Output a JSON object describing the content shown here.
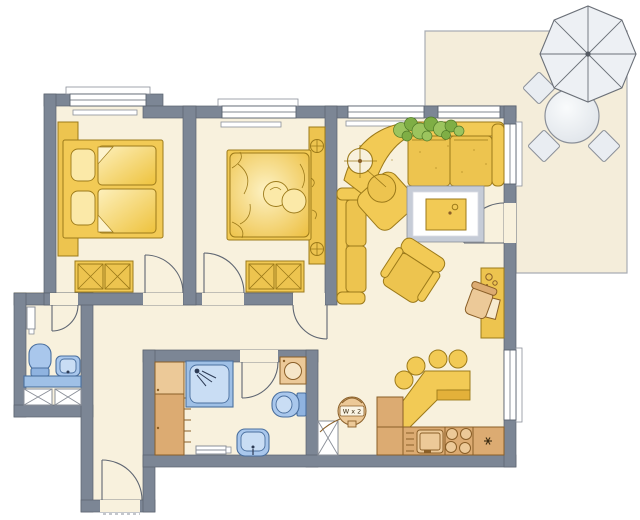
{
  "plan": {
    "type": "apartment-floor-plan",
    "boiler_label": "W x 2",
    "palette": {
      "wall": "#7c8695",
      "wallEdge": "#5a626e",
      "floor": "#f8f1dd",
      "gold": "#f2ca55",
      "goldMid": "#edc44f",
      "goldPale": "#fbe9a8",
      "goldDeep": "#e3b13a",
      "goldDark": "#9c7a1a",
      "tan": "#dcab72",
      "tanLight": "#ecc998",
      "tanDark": "#8a5f28",
      "blue": "#8fb3e0",
      "blueMid": "#a9c7ec",
      "blueLight": "#c9ddf4",
      "blueDark": "#4a6f9e",
      "counterBlue": "#9fc0e6",
      "grayEdge": "#8a8f98",
      "doorLine": "#5f6672",
      "terrace": "#f4edda",
      "terraceLine": "#a9adb3",
      "parasol": "#edf0f4",
      "parasolLine": "#6b7078",
      "chairGray": "#e9edf2",
      "green": "#9cc45e",
      "green2": "#7fae45",
      "greenDark": "#4f7a28",
      "rugBorder": "#c6ccd7",
      "rugInner": "#ffffff"
    },
    "rooms": [
      {
        "name": "bedroom-1",
        "furniture": [
          "double-bed",
          "pillows",
          "duvets",
          "headboard-panel",
          "wardrobe",
          "window",
          "door"
        ]
      },
      {
        "name": "bedroom-2",
        "furniture": [
          "double-bed",
          "round-pillows",
          "bedside-console",
          "wardrobe",
          "window",
          "door"
        ]
      },
      {
        "name": "living-room",
        "furniture": [
          "corner-sofa",
          "attached-armchair",
          "floor-lamp",
          "plant",
          "rug",
          "coffee-table",
          "two-seat-sofa",
          "lounge-chair",
          "desk",
          "desk-chair",
          "terrace-door",
          "windows"
        ]
      },
      {
        "name": "dining-area",
        "furniture": [
          "corner-bench-table",
          "stool",
          "stool",
          "stool",
          "stool"
        ]
      },
      {
        "name": "kitchen",
        "furniture": [
          "corner-cabinet",
          "sink-unit",
          "stove",
          "freezer-cabinet",
          "tall-cupboard",
          "boiler",
          "window"
        ]
      },
      {
        "name": "bathroom",
        "furniture": [
          "shower",
          "washing-machine",
          "toilet",
          "washbasin",
          "radiator",
          "tall-cabinet",
          "door"
        ]
      },
      {
        "name": "wc",
        "furniture": [
          "toilet",
          "washbasin",
          "vanity-counter",
          "under-counter-cabinets",
          "radiator",
          "door"
        ]
      },
      {
        "name": "hallway",
        "furniture": [
          "entrance-door",
          "threshold"
        ]
      },
      {
        "name": "terrace",
        "furniture": [
          "parasol",
          "round-table",
          "chair",
          "chair",
          "chair"
        ]
      }
    ]
  }
}
